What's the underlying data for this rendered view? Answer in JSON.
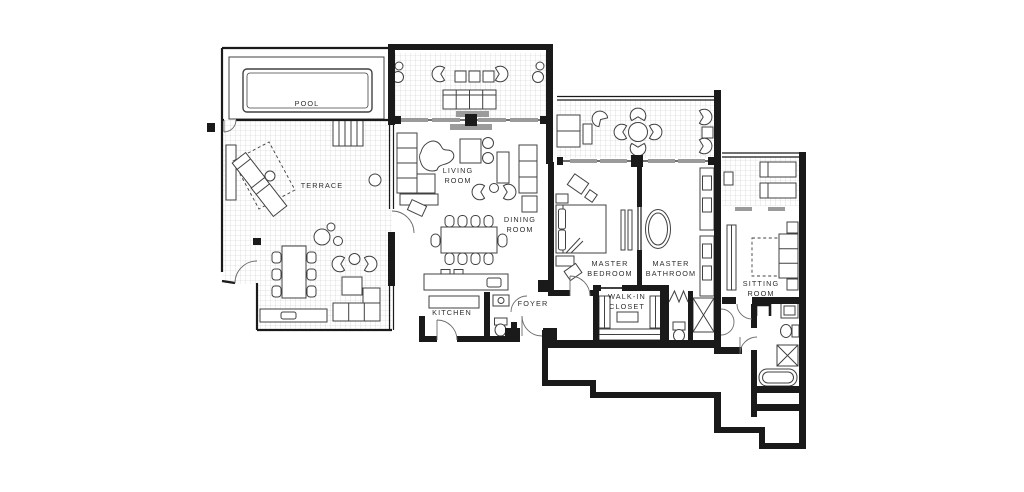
{
  "document": {
    "kind": "floor-plan"
  },
  "colors": {
    "wall": "#1a1a1a",
    "tile_grid": "#c9c9c9",
    "furniture": "#414141",
    "label": "#2e2e2e",
    "panel": "#9b9b9b",
    "background": "#ffffff"
  },
  "rooms": {
    "pool": {
      "label": "POOL"
    },
    "terrace": {
      "label": "TERRACE"
    },
    "living_room": {
      "line1": "LIVING",
      "line2": "ROOM"
    },
    "dining_room": {
      "line1": "DINING",
      "line2": "ROOM"
    },
    "kitchen": {
      "label": "KITCHEN"
    },
    "foyer": {
      "label": "FOYER"
    },
    "master_bedroom": {
      "line1": "MASTER",
      "line2": "BEDROOM"
    },
    "master_bathroom": {
      "line1": "MASTER",
      "line2": "BATHROOM"
    },
    "walk_in_closet": {
      "line1": "WALK-IN",
      "line2": "CLOSET"
    },
    "sitting_room": {
      "line1": "SITTING",
      "line2": "ROOM"
    }
  }
}
